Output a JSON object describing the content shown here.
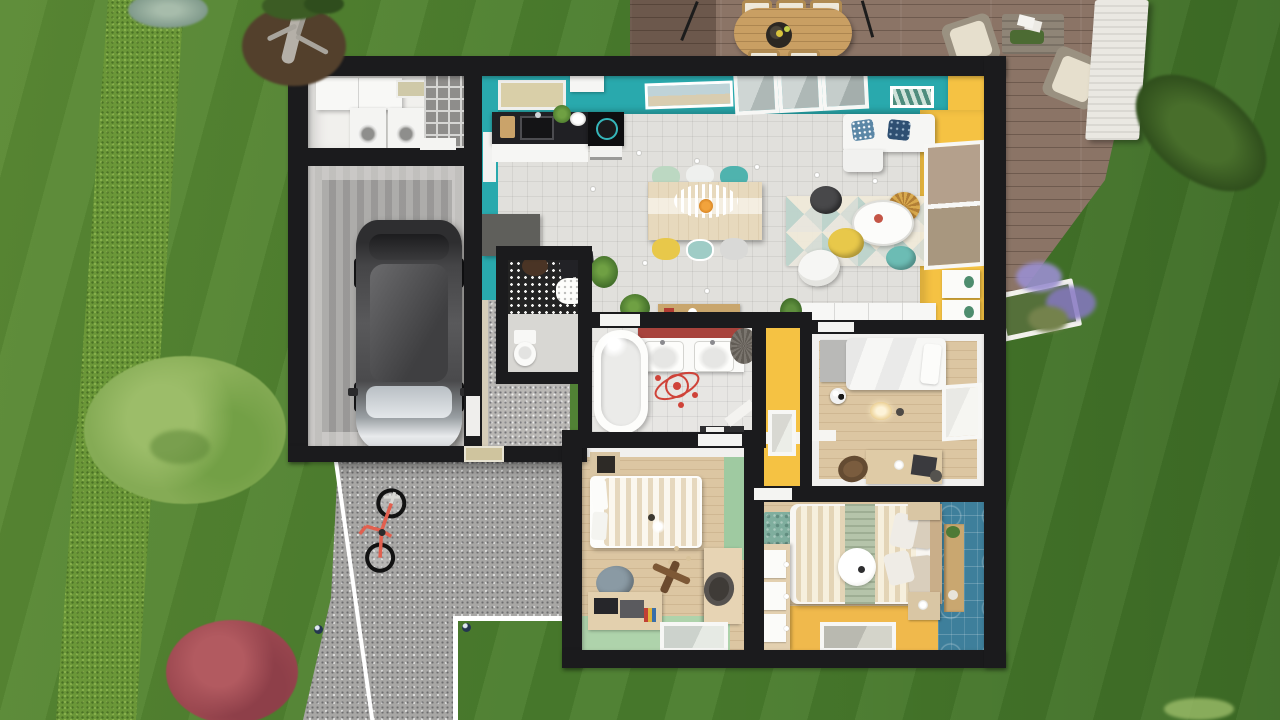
{
  "scene": {
    "kind": "3d-top-down-floor-plan-render",
    "view": "aerial cutaway of single-storey house with garden, deck and driveway"
  },
  "colors": {
    "grass": "#4a7d2d",
    "hedge": "#6b9738",
    "tree_light": "#85ab55",
    "bush_red": "#9c4850",
    "conifer": "#33521f",
    "dirt": "#53402c",
    "deck": "#8b7466",
    "deck_table": "#c99f63",
    "stone_pillar": "#eae8e2",
    "driveway": "#a8a7a5",
    "curb": "#ffffff",
    "house_wall": "#1b1b1d",
    "teal_wall": "#29a9ad",
    "yellow_wall": "#f5c243",
    "blue_wall": "#3e7f9b",
    "mint_wall": "#9fcaa1",
    "mint_floor": "#aed3ab",
    "red_stripe": "#a8433c",
    "tile_floor": "#e1e0dc",
    "wood_floor": "#dcc6a2",
    "yellow_floor": "#f0b94c",
    "concrete": "#a5a4a2",
    "utility_floor": "#f1f0ed",
    "hall_floor": "#b9b7b4",
    "counter_black": "#202024",
    "furniture_white": "#f6f6f4",
    "rug_teal": "#7fae9e",
    "accent_red": "#cf4339",
    "bike_frame": "#e2604f",
    "sofa_pillow_blue": "#5b87a6",
    "sofa_pillow_navy": "#2e4f72",
    "chair_mint": "#bcd8c2",
    "chair_teal": "#4fb3ae",
    "chair_yellow": "#e8c84a",
    "pouf_dark": "#48484a",
    "lavender": "#9a8fd0"
  },
  "house": {
    "rooms": [
      {
        "name": "utility-room",
        "items": [
          "wall-cabinet",
          "washer",
          "dryer",
          "wire-storage-rack"
        ]
      },
      {
        "name": "garage",
        "items": [
          "car"
        ]
      },
      {
        "name": "kitchen",
        "items": [
          "black-counter-with-sink",
          "cooktop",
          "oven",
          "hood",
          "tall-gray-cabinet",
          "pantry-door"
        ]
      },
      {
        "name": "dining-area",
        "items": [
          "wood-table",
          "striped-pendant-lamp",
          "six-mixed-chairs"
        ]
      },
      {
        "name": "living-area",
        "items": [
          "white-corner-sofa",
          "triangle-rug",
          "round-coffee-table",
          "yellow-pouf",
          "teal-pouf",
          "dark-pouf",
          "rattan-pendant",
          "armchair",
          "drawer-consoles",
          "wall-art",
          "picture-window"
        ]
      },
      {
        "name": "entry-hall",
        "items": [
          "front-door",
          "console-table",
          "potted-plants",
          "desk-nook"
        ]
      },
      {
        "name": "wc",
        "items": [
          "toilet",
          "patterned-accent-wall"
        ]
      },
      {
        "name": "bathroom",
        "items": [
          "bathtub",
          "double-sink-vanity",
          "red-wall-stripe",
          "laundry-basket",
          "atom-floor-decal",
          "towel-rail"
        ]
      },
      {
        "name": "yellow-hallway",
        "items": [
          "window",
          "white-ledge"
        ]
      },
      {
        "name": "kids-bedroom-white",
        "items": [
          "single-bed",
          "gray-headboard-cabinet",
          "soccer-ball",
          "ceiling-lamp",
          "desk",
          "chair",
          "window",
          "wall-shelf",
          "closet-row"
        ]
      },
      {
        "name": "kids-bedroom-mint",
        "items": [
          "double-bed-striped",
          "nightstand",
          "bean-bag",
          "toy-plane",
          "desk-with-laptop",
          "wardrobe",
          "desk-chair",
          "flat-window",
          "ceiling-lamp"
        ]
      },
      {
        "name": "master-bedroom",
        "items": [
          "double-bed",
          "sage-throw",
          "round-ceiling-lamp",
          "dresser-three-drawers",
          "teal-rug",
          "nightstand-top",
          "nightstand-bottom",
          "wall-shelf",
          "flat-window",
          "blue-pattern-wall"
        ]
      }
    ]
  },
  "outdoor": {
    "items": [
      "lawn",
      "hedge-row",
      "deciduous-tree",
      "red-bush",
      "leaning-conifer",
      "bare-tree-with-dirt",
      "teal-shrub",
      "wood-deck",
      "outdoor-oval-table",
      "outdoor-chairs",
      "parasol-poles",
      "fruit-bowl",
      "lounge-armchairs",
      "planter-coffee-table",
      "stone-pillar",
      "lavender-planter",
      "gravel-driveway",
      "white-curbs",
      "fallen-bicycle",
      "path-lights",
      "grass-tuft"
    ]
  }
}
